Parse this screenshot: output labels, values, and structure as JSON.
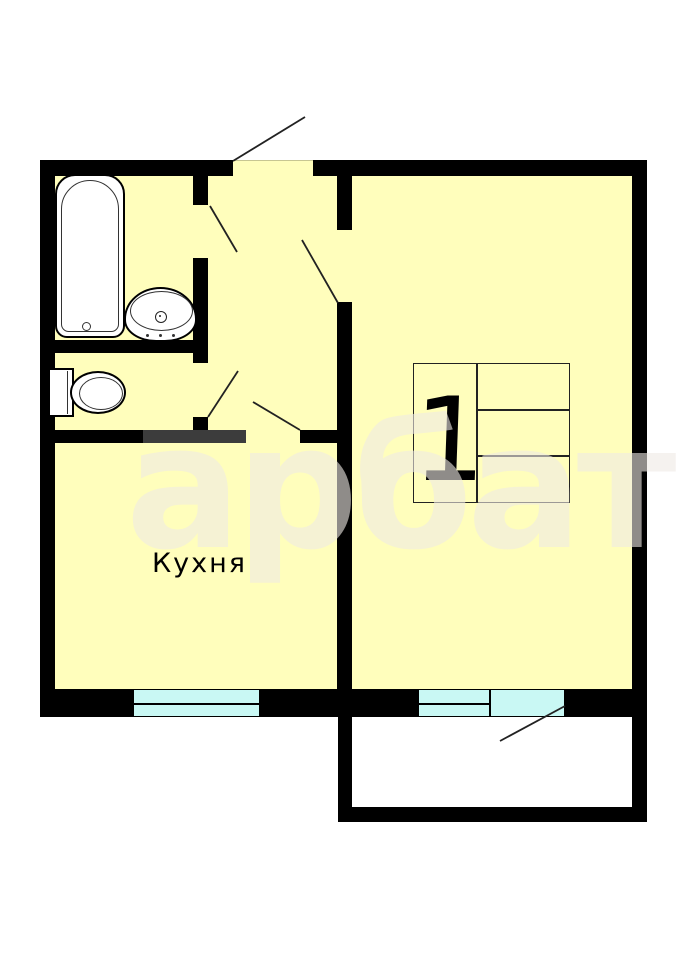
{
  "plan_type": "apartment-floor-plan",
  "watermark": {
    "text": "арбат"
  },
  "rooms": {
    "kitchen": {
      "label": "Кухня"
    },
    "room1": {
      "number": "1"
    }
  },
  "fixtures": {
    "bathtub": "bathtub",
    "sink": "wash-basin",
    "toilet": "toilet"
  },
  "features": {
    "windows": [
      "kitchen-window",
      "living-room-window",
      "balcony-door-glazing"
    ],
    "doors": [
      "entrance-door",
      "bathroom-door",
      "wc-door",
      "kitchen-door",
      "living-room-door",
      "balcony-door"
    ]
  },
  "colors": {
    "floor": "#FFFEBC",
    "walls": "#000000",
    "partition_gray": "#3C3C3C",
    "window_glass": "#C9F8F4",
    "outline": "#222222",
    "watermark": "rgba(238,234,228,0.60)"
  }
}
